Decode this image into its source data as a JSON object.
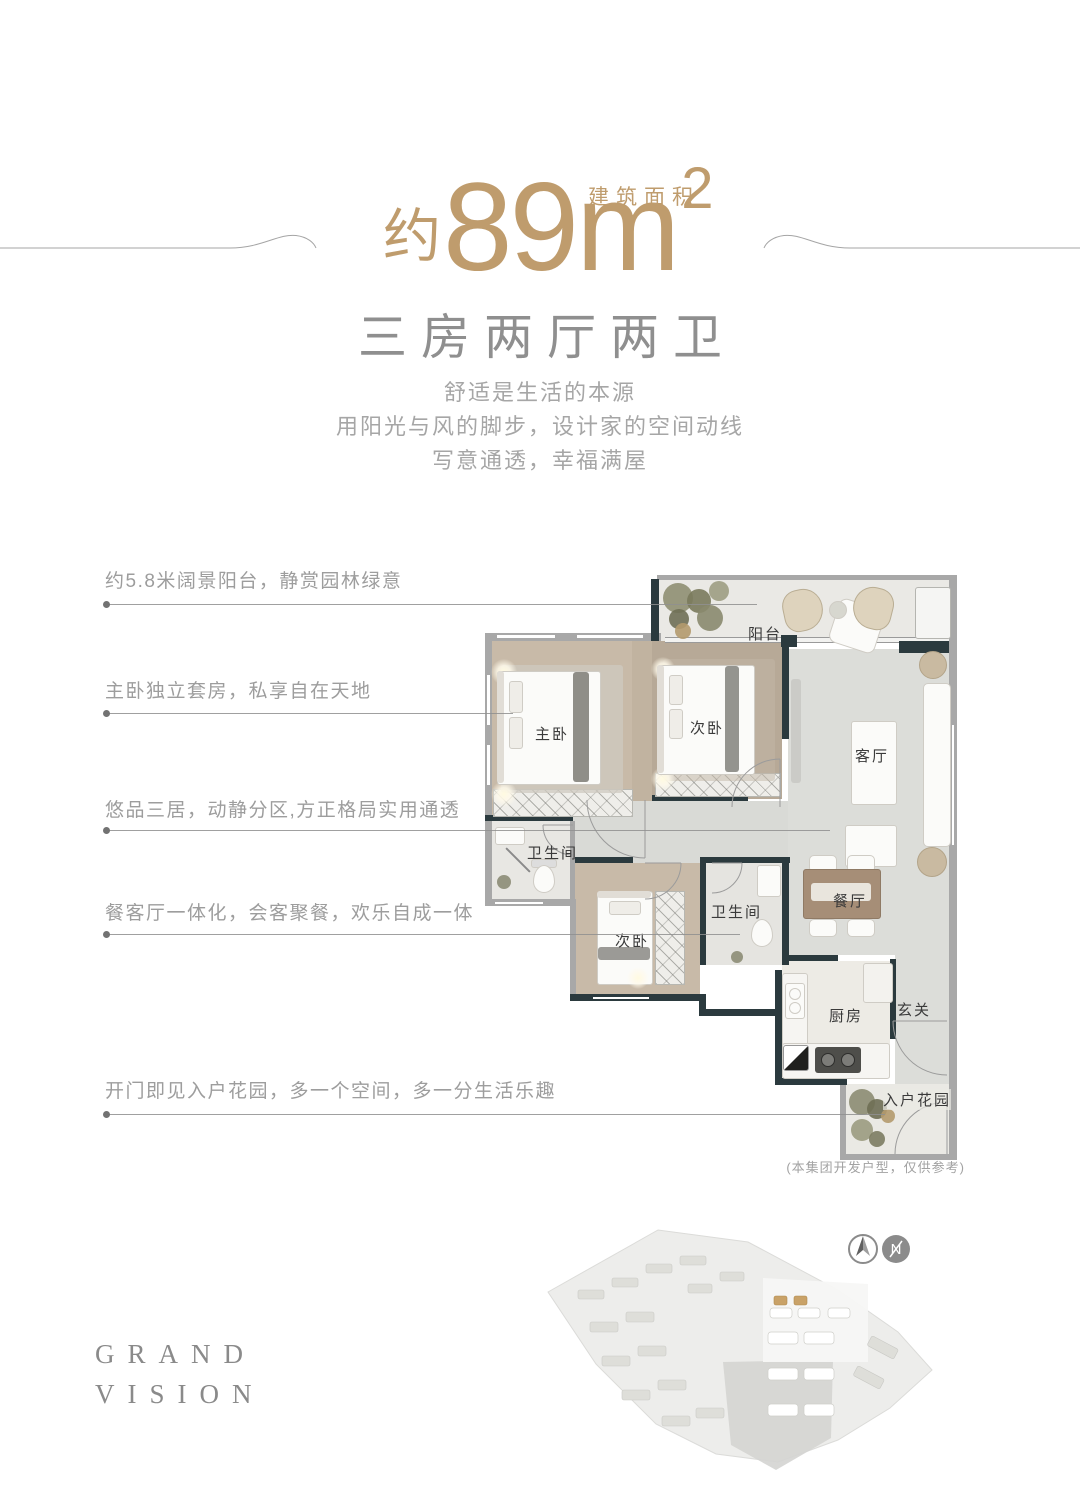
{
  "header": {
    "area_label": "建筑面积",
    "area_prefix": "约",
    "area_value": "89",
    "area_unit": "m",
    "area_sup": "2",
    "title": "三房两厅两卫",
    "desc_line1": "舒适是生活的本源",
    "desc_line2": "用阳光与风的脚步，设计家的空间动线",
    "desc_line3": "写意通透，幸福满屋"
  },
  "callouts": [
    {
      "text": "约5.8米阔景阳台，静赏园林绿意"
    },
    {
      "text": "主卧独立套房，私享自在天地"
    },
    {
      "text": "悠品三居，动静分区,方正格局实用通透"
    },
    {
      "text": "餐客厅一体化，会客聚餐，欢乐自成一体"
    },
    {
      "text": "开门即见入户花园，多一个空间，多一分生活乐趣"
    }
  ],
  "floorplan": {
    "rooms": {
      "balcony": "阳台",
      "master_bedroom": "主卧",
      "bedroom2": "次卧",
      "living_room": "客厅",
      "bathroom1": "卫生间",
      "bedroom3": "次卧",
      "bathroom2": "卫生间",
      "dining_room": "餐厅",
      "kitchen": "厨房",
      "foyer": "玄关",
      "entry_garden": "入户花园"
    },
    "disclaimer": "(本集团开发户型，仅供参考)"
  },
  "footer": {
    "brand_line1": "GRAND",
    "brand_line2": "VISION",
    "compass_letter": "N"
  },
  "colors": {
    "accent_gold": "#bf9c6d",
    "wall_dark": "#2b3a3e",
    "wall_gray": "#a8a8a8",
    "wood_floor": "#c8baa8",
    "map_highlight_gold": "#c9a268"
  }
}
